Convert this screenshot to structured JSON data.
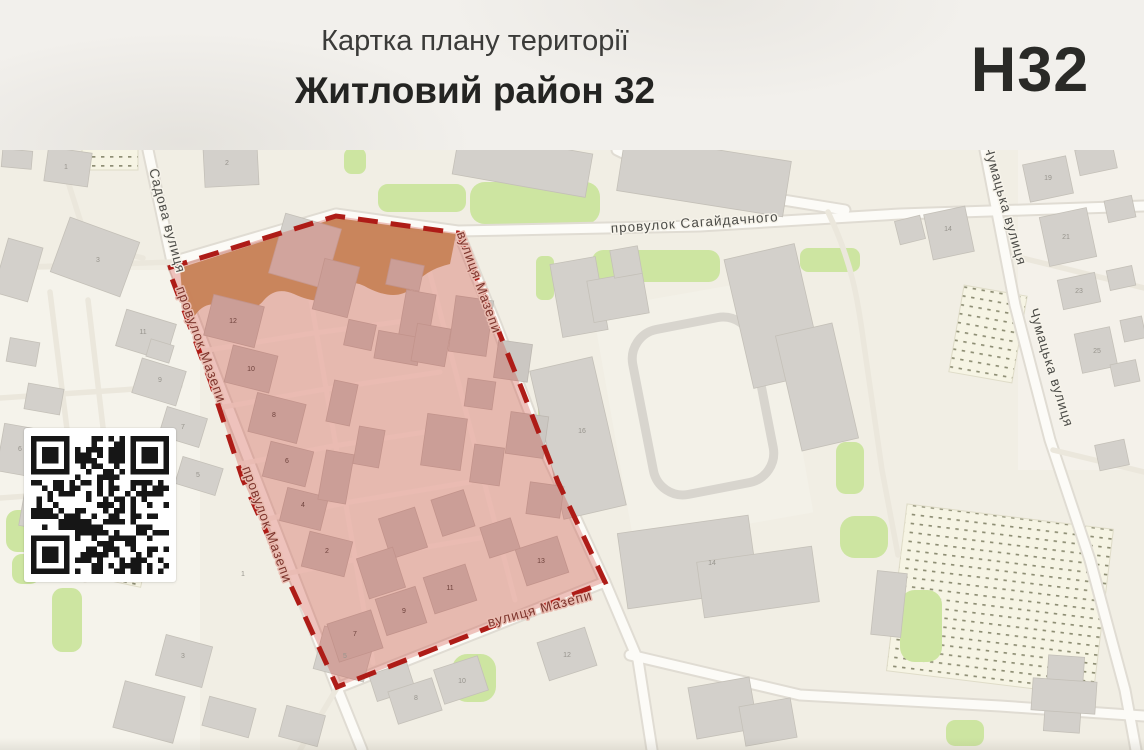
{
  "header": {
    "subtitle": "Картка плану території",
    "title": "Житловий район 32",
    "code": "Н32"
  },
  "map": {
    "street_labels": [
      {
        "text": "Садова вулиця",
        "x": 163,
        "y": 222,
        "rotate": 75,
        "cls": "out"
      },
      {
        "text": "провулок Мазепи",
        "x": 197,
        "y": 346,
        "rotate": 70,
        "cls": "zone"
      },
      {
        "text": "провулок Мазепи",
        "x": 263,
        "y": 526,
        "rotate": 70,
        "cls": "zone"
      },
      {
        "text": "вулиця Мазепи",
        "x": 475,
        "y": 284,
        "rotate": 70,
        "cls": "zone"
      },
      {
        "text": "вулиця Мазепи",
        "x": 541,
        "y": 613,
        "rotate": -15,
        "cls": "zone"
      },
      {
        "text": "провулок Сагайдачного",
        "x": 695,
        "y": 227,
        "rotate": -4,
        "cls": "out"
      },
      {
        "text": "Чумацька вулиця",
        "x": 1001,
        "y": 207,
        "rotate": 74,
        "cls": "out"
      },
      {
        "text": "Чумацька вулиця",
        "x": 1047,
        "y": 369,
        "rotate": 73,
        "cls": "out"
      }
    ],
    "parcel_numbers": [
      {
        "text": "12",
        "x": 233,
        "y": 323,
        "cls": "zone"
      },
      {
        "text": "10",
        "x": 251,
        "y": 371,
        "cls": "zone"
      },
      {
        "text": "8",
        "x": 274,
        "y": 417,
        "cls": "zone"
      },
      {
        "text": "6",
        "x": 287,
        "y": 463,
        "cls": "zone"
      },
      {
        "text": "4",
        "x": 303,
        "y": 507,
        "cls": "zone"
      },
      {
        "text": "2",
        "x": 327,
        "y": 553,
        "cls": "zone"
      },
      {
        "text": "7",
        "x": 355,
        "y": 636,
        "cls": "zone"
      },
      {
        "text": "9",
        "x": 404,
        "y": 613,
        "cls": "zone"
      },
      {
        "text": "11",
        "x": 450,
        "y": 590,
        "cls": "zone"
      },
      {
        "text": "13",
        "x": 541,
        "y": 563,
        "cls": "zone"
      },
      {
        "text": "1",
        "x": 66,
        "y": 169,
        "cls": "out"
      },
      {
        "text": "2",
        "x": 227,
        "y": 165,
        "cls": "out"
      },
      {
        "text": "3",
        "x": 98,
        "y": 262,
        "cls": "out"
      },
      {
        "text": "11",
        "x": 143,
        "y": 334,
        "cls": "out"
      },
      {
        "text": "9",
        "x": 160,
        "y": 382,
        "cls": "out"
      },
      {
        "text": "7",
        "x": 183,
        "y": 429,
        "cls": "out"
      },
      {
        "text": "6",
        "x": 20,
        "y": 451,
        "cls": "out"
      },
      {
        "text": "5",
        "x": 198,
        "y": 477,
        "cls": "out"
      },
      {
        "text": "4",
        "x": 44,
        "y": 508,
        "cls": "out"
      },
      {
        "text": "2",
        "x": 66,
        "y": 558,
        "cls": "out"
      },
      {
        "text": "1",
        "x": 243,
        "y": 576,
        "cls": "out"
      },
      {
        "text": "3",
        "x": 183,
        "y": 658,
        "cls": "out"
      },
      {
        "text": "5",
        "x": 345,
        "y": 658,
        "cls": "out"
      },
      {
        "text": "8",
        "x": 416,
        "y": 700,
        "cls": "out"
      },
      {
        "text": "10",
        "x": 462,
        "y": 683,
        "cls": "out"
      },
      {
        "text": "12",
        "x": 567,
        "y": 657,
        "cls": "out"
      },
      {
        "text": "16",
        "x": 582,
        "y": 433,
        "cls": "out"
      },
      {
        "text": "14",
        "x": 712,
        "y": 565,
        "cls": "out"
      },
      {
        "text": "14",
        "x": 948,
        "y": 231,
        "cls": "out"
      },
      {
        "text": "19",
        "x": 1048,
        "y": 180,
        "cls": "out"
      },
      {
        "text": "21",
        "x": 1066,
        "y": 239,
        "cls": "out"
      },
      {
        "text": "23",
        "x": 1079,
        "y": 293,
        "cls": "out"
      },
      {
        "text": "25",
        "x": 1097,
        "y": 353,
        "cls": "out"
      }
    ]
  },
  "colors": {
    "zone_fill": "#cd3e34",
    "zone_border": "#ae1c17",
    "map_background": "#f1eee4",
    "building": "#d3d0cb",
    "green_area": "#cde5a1",
    "bare_ground": "#c59f66"
  }
}
